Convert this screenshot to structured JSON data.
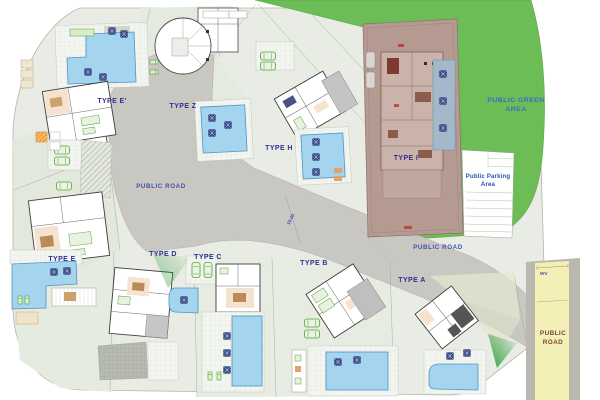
{
  "drawing": {
    "type_labels": [
      {
        "id": "type-e-prime",
        "label": "TYPE E'"
      },
      {
        "id": "type-z",
        "label": "TYPE Z"
      },
      {
        "id": "type-h",
        "label": "TYPE H"
      },
      {
        "id": "type-i",
        "label": "TYPE I"
      },
      {
        "id": "type-e",
        "label": "TYPE E"
      },
      {
        "id": "type-d",
        "label": "TYPE D"
      },
      {
        "id": "type-c",
        "label": "TYPE C"
      },
      {
        "id": "type-b",
        "label": "TYPE B"
      },
      {
        "id": "type-a",
        "label": "TYPE A"
      }
    ],
    "green_area": {
      "line1": "PUBLIC GREEN",
      "line2": "AREA"
    },
    "parking": {
      "line1": "Public Parking",
      "line2": "Area"
    },
    "roads": {
      "west_label": "PUBLIC ROAD",
      "east_label": "PUBLIC ROAD",
      "south_label_line1": "PUBLIC",
      "south_label_line2": "ROAD",
      "width_annotation": "10.00",
      "utility_annotation": "WV"
    },
    "colors": {
      "site": "#e9ece4",
      "green_area": "#6cbd55",
      "road": "#c9c7c2",
      "yellow_road": "#f4efb6",
      "type_i_plot": "#b59a91",
      "pool": "#a5d4ee",
      "pool_border": "#4f94c4",
      "umbrella": "#2a3470",
      "type_label": "#2e3192",
      "road_label": "#4052a8",
      "green_label": "#3a6bc6",
      "south_road_label": "#7a453b"
    }
  }
}
